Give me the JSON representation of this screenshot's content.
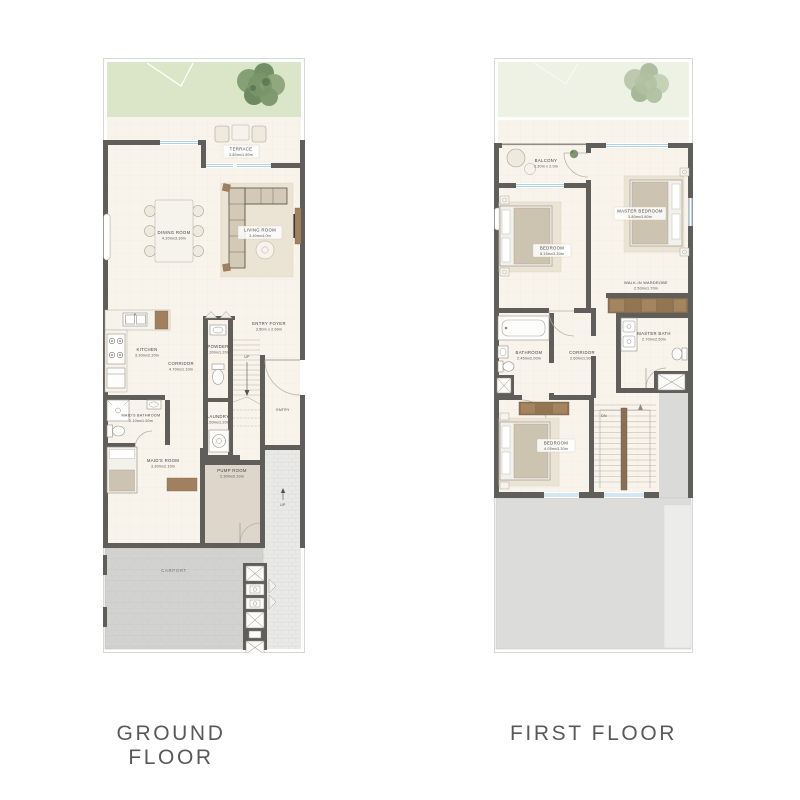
{
  "titles": {
    "ground": "GROUND FLOOR",
    "first": "FIRST FLOOR"
  },
  "ground": {
    "rooms": [
      {
        "name": "TERRACE",
        "dims": "3.80mx1.80m"
      },
      {
        "name": "DINING ROOM",
        "dims": "4.20mx3.30m"
      },
      {
        "name": "LIVING ROOM",
        "dims": "3.40mx4.0m"
      },
      {
        "name": "KITCHEN",
        "dims": "3.30mx2.20m"
      },
      {
        "name": "CORRIDOR",
        "dims": "4.70mx1.10m"
      },
      {
        "name": "POWDER",
        "dims": "2.30mx1.20m"
      },
      {
        "name": "ENTRY FOYER",
        "dims": "3.50m x 2.60m"
      },
      {
        "name": "LAUNDRY",
        "dims": "1.50mx1.20m"
      },
      {
        "name": "MAID'S BATHROOM",
        "dims": "2.10mx1.50m"
      },
      {
        "name": "MAID'S ROOM",
        "dims": "3.30mx2.10m"
      },
      {
        "name": "PUMP ROOM",
        "dims": "2.30mx2.10m"
      },
      {
        "name": "CARPORT",
        "dims": ""
      }
    ],
    "annotations": {
      "up_stairs": "UP",
      "up_entry": "UP",
      "entry": "ENTRY"
    }
  },
  "first": {
    "rooms": [
      {
        "name": "BALCONY",
        "dims": "3.30m x 2.0m"
      },
      {
        "name": "MASTER BEDROOM",
        "dims": "3.80mx3.80m"
      },
      {
        "name": "BEDROOM",
        "dims": "5.15mx3.30m"
      },
      {
        "name": "WALK-IN WARDROBE",
        "dims": "2.50mx1.70m"
      },
      {
        "name": "MASTER BATH",
        "dims": "2.70mx2.50m"
      },
      {
        "name": "BATHROOM",
        "dims": "2.45mx2.00m"
      },
      {
        "name": "CORRIDOR",
        "dims": "2.60mx1.90m"
      },
      {
        "name": "BEDROOM",
        "dims": "4.05mx3.30m"
      }
    ],
    "annotations": {
      "dn": "DN"
    }
  },
  "colors": {
    "wall": "#5f5e5b",
    "floor": "#f8f4ec",
    "garden": "#dbe6c8",
    "garden_faded": "#edf2e5",
    "carport": "#d2d2d0",
    "window": "#a9cce2",
    "label": "#46453f",
    "title": "#59595b"
  }
}
